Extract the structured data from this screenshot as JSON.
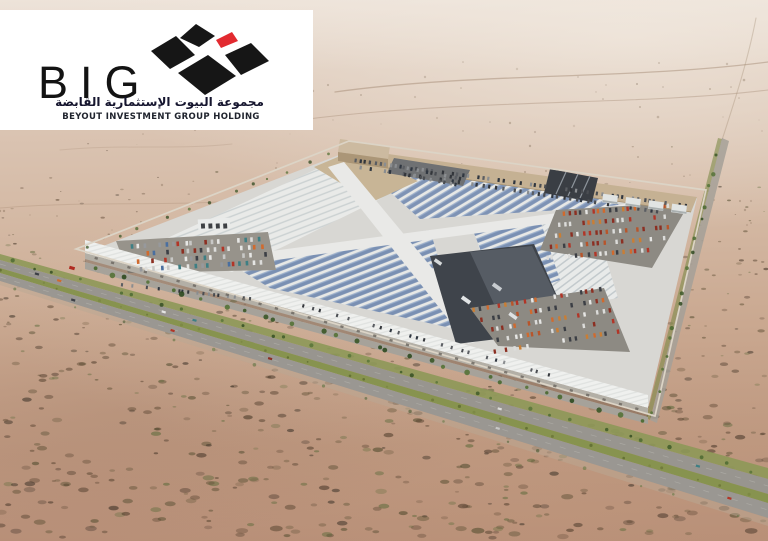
{
  "logo_card": {
    "wordmark": "BIG",
    "arabic_name": "مجموعة البيوت الإستثمارية القابضة",
    "english_name": "BEYOUT INVESTMENT GROUP HOLDING",
    "colors": {
      "card_bg": "#ffffff",
      "diamond_black": "#161616",
      "diamond_red": "#e22a30",
      "wordmark_text": "#131313",
      "arabic_text": "#15152e",
      "english_text": "#20242e"
    }
  },
  "scene": {
    "alt": "Aerial 3D rendering of a large solar-roofed vehicle market complex in open desert beside a divided highway",
    "palette": {
      "desert_top": "#e6d8cc",
      "desert_mid": "#d4b9a4",
      "desert_foreground": "#b78e77",
      "site_concrete": "#d8d7d3",
      "roof_white": "#ecedeb",
      "solar_blue": "#7a90b3",
      "asphalt": "#8e8b84",
      "yard_dark": "#3f444b",
      "building_tan": "#c5b193",
      "road_gray": "#98958f",
      "median_green": "#87934f",
      "tree_green": "#3b5727",
      "wall_line": "#dcd4c6",
      "car_colors": [
        "#e6e6e4",
        "#dcdcda",
        "#b23527",
        "#d06a2e",
        "#97999c",
        "#3c3f45",
        "#4a6fa0",
        "#8c2f22",
        "#3e7f84",
        "#c8c8c6"
      ]
    }
  }
}
